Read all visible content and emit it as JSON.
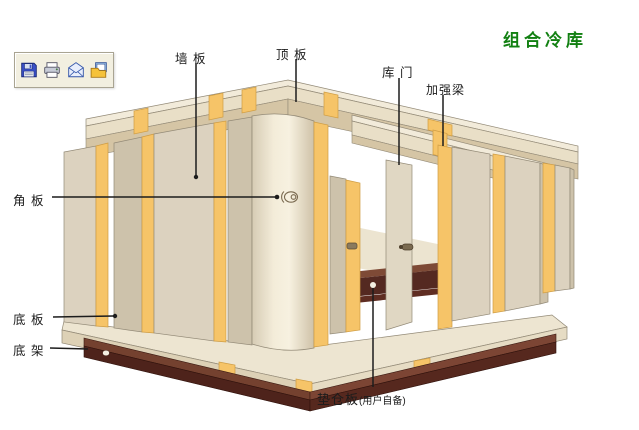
{
  "title": {
    "text": "组合冷库",
    "color": "#128012"
  },
  "toolbar": {
    "buttons": [
      {
        "id": "save",
        "icon": "floppy-disk-icon"
      },
      {
        "id": "print",
        "icon": "printer-icon"
      },
      {
        "id": "mail",
        "icon": "envelope-icon"
      },
      {
        "id": "export",
        "icon": "export-image-icon"
      }
    ]
  },
  "diagram": {
    "type": "exploded-assembly-diagram",
    "subject": "modular cold storage room (组合冷库) exploded view",
    "parts": [
      {
        "id": "wall-panel",
        "label": "墙 板"
      },
      {
        "id": "top-panel",
        "label": "顶 板"
      },
      {
        "id": "door",
        "label": "库 门"
      },
      {
        "id": "reinforcement-beam",
        "label": "加强梁"
      },
      {
        "id": "corner-panel",
        "label": "角 板"
      },
      {
        "id": "bottom-panel",
        "label": "底 板"
      },
      {
        "id": "bottom-frame",
        "label": "底 架"
      },
      {
        "id": "pallet-board",
        "label": "垫仓板",
        "note": "(用户自备)"
      }
    ]
  },
  "palette": {
    "ink": "#1c1c1c",
    "titlegreen": "#128012",
    "toolbarbg": "#f2efe0",
    "toolbarborder": "#a9a492",
    "panel": "#dcd2bf",
    "paneldark": "#cdc2ab",
    "panellight": "#f6f0de",
    "orange": "#f6c468",
    "orangeedge": "#cf9d44",
    "rooftop": "#f2ebda",
    "roofedge": "#e9dfc7",
    "roofunder": "#d5c5a5",
    "floortop": "#ede5d1",
    "flooredge": "#ddd1b6",
    "frametop": "#74412f",
    "framedark": "#4e231b",
    "pallettop": "#7e4a36",
    "palletface": "#542921",
    "outline": "#938a77"
  }
}
